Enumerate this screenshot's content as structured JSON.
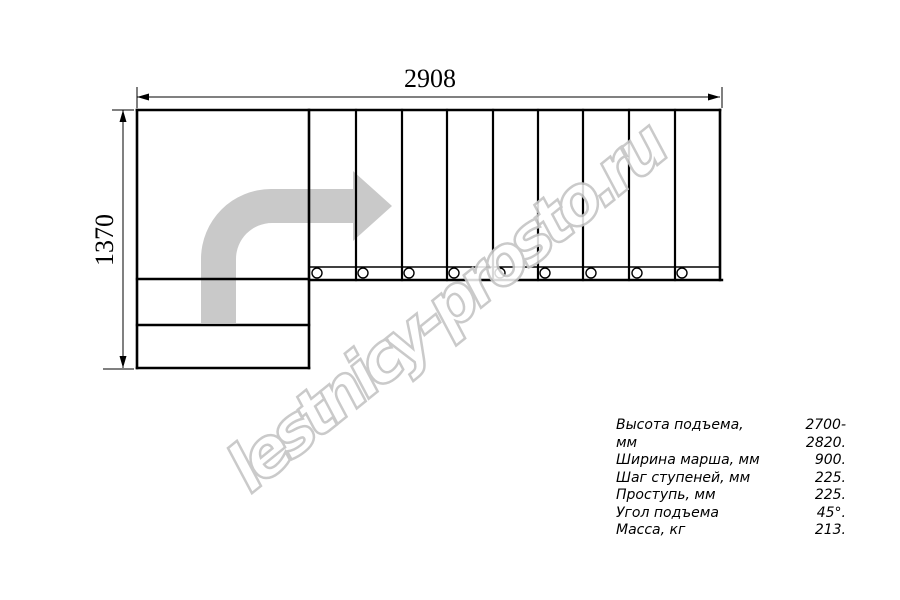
{
  "drawing": {
    "width_label": "2908",
    "height_label": "1370",
    "flight_steps_count": 9,
    "lower_steps_count": 2,
    "fastener_circles_count": 9,
    "arrow_color": "#c9c9c9",
    "line_color": "#000000"
  },
  "watermark": {
    "text": "lestnicy-prosto.ru",
    "outline_color": "#c6c6c6"
  },
  "specs": {
    "rows": [
      {
        "label": "Высота подъема, мм",
        "value": "2700-2820."
      },
      {
        "label": "Ширина марша, мм",
        "value": "900."
      },
      {
        "label": "Шаг ступеней, мм",
        "value": "225."
      },
      {
        "label": "Проступь, мм",
        "value": "225."
      },
      {
        "label": "Угол подъема",
        "value": "45°."
      },
      {
        "label": "Масса, кг",
        "value": "213."
      }
    ]
  }
}
